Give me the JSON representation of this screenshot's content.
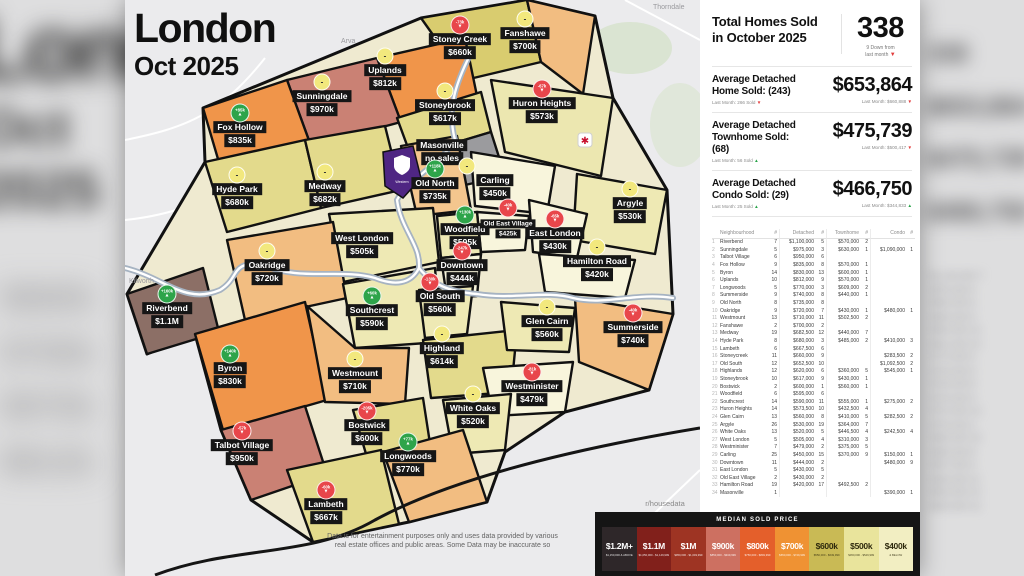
{
  "title": {
    "line1": "London",
    "line2": "Oct 2025"
  },
  "map": {
    "place_labels": [
      "Arva",
      "Thorndale",
      "Kilworth"
    ],
    "university_label": "Western",
    "badge_colors": {
      "up": "#2ea44a",
      "down": "#e8464b",
      "neutral": "#f2e87d"
    },
    "regions": [
      {
        "id": "stoney-creek",
        "name": "Stoney Creek",
        "price": "$660k",
        "fill": "#d9cc6f",
        "x": 335,
        "y": 46,
        "badge": {
          "dir": "down",
          "text": "-73k"
        }
      },
      {
        "id": "fanshawe",
        "name": "Fanshawe",
        "price": "$700k",
        "fill": "#f2bd81",
        "x": 400,
        "y": 40,
        "badge": {
          "dir": "neutral"
        }
      },
      {
        "id": "sunningdale",
        "name": "Sunningdale",
        "price": "$970k",
        "fill": "#ca8174",
        "x": 197,
        "y": 103,
        "badge": {
          "dir": "neutral"
        }
      },
      {
        "id": "uplands",
        "name": "Uplands",
        "price": "$812k",
        "fill": "#f0954a",
        "x": 260,
        "y": 77,
        "badge": {
          "dir": "neutral"
        }
      },
      {
        "id": "fox-hollow",
        "name": "Fox Hollow",
        "price": "$835k",
        "fill": "#f0954a",
        "x": 115,
        "y": 134,
        "badge": {
          "dir": "up",
          "text": "+85k"
        }
      },
      {
        "id": "stoneybrook",
        "name": "Stoneybrook",
        "price": "$617k",
        "fill": "#e3da8c",
        "x": 320,
        "y": 112,
        "badge": {
          "dir": "neutral"
        }
      },
      {
        "id": "huron-heights",
        "name": "Huron Heights",
        "price": "$573k",
        "fill": "#ece7b0",
        "x": 417,
        "y": 110,
        "badge": {
          "dir": "down",
          "text": "-67k"
        }
      },
      {
        "id": "masonville",
        "name": "Masonville",
        "price": "no sales",
        "fill": "#9b9b9e",
        "x": 317,
        "y": 152
      },
      {
        "id": "hyde-park",
        "name": "Hyde Park",
        "price": "$680k",
        "fill": "#e3da8c",
        "x": 112,
        "y": 196,
        "badge": {
          "dir": "neutral"
        }
      },
      {
        "id": "medway",
        "name": "Medway",
        "price": "$682k",
        "fill": "#e3da8c",
        "x": 200,
        "y": 193,
        "badge": {
          "dir": "neutral"
        }
      },
      {
        "id": "old-north",
        "name": "Old North",
        "price": "$735k",
        "fill": "#f4c68e",
        "x": 310,
        "y": 190,
        "badge": {
          "dir": "up",
          "text": "+118k"
        }
      },
      {
        "id": "carling",
        "name": "Carling",
        "price": "$450k",
        "fill": "#f8f5dc",
        "x": 370,
        "y": 187,
        "badge": {
          "dir": "neutral",
          "dx": -28
        }
      },
      {
        "id": "argyle",
        "name": "Argyle",
        "price": "$530k",
        "fill": "#eee9b4",
        "x": 505,
        "y": 210,
        "badge": {
          "dir": "neutral"
        }
      },
      {
        "id": "woodfield",
        "name": "Woodfield",
        "price": "$595k",
        "fill": "#eee9b4",
        "x": 340,
        "y": 236,
        "badge": {
          "dir": "up",
          "text": "+130k"
        }
      },
      {
        "id": "old-east-village",
        "name": "Old East Village",
        "price": "$425k",
        "fill": "#f8f5dc",
        "x": 383,
        "y": 229,
        "small": true,
        "badge": {
          "dir": "down",
          "text": "-40k"
        }
      },
      {
        "id": "east-london",
        "name": "East London",
        "price": "$430k",
        "fill": "#f8f5dc",
        "x": 430,
        "y": 240,
        "badge": {
          "dir": "down",
          "text": "-65k"
        }
      },
      {
        "id": "west-london",
        "name": "West London",
        "price": "$505k",
        "fill": "#eee9b4",
        "x": 237,
        "y": 245
      },
      {
        "id": "downtown",
        "name": "Downtown",
        "price": "$444k",
        "fill": "#f8f5dc",
        "x": 337,
        "y": 272,
        "badge": {
          "dir": "down",
          "text": "-247k"
        }
      },
      {
        "id": "hamilton-road",
        "name": "Hamilton Road",
        "price": "$420k",
        "fill": "#f8f5dc",
        "x": 472,
        "y": 268,
        "badge": {
          "dir": "neutral"
        }
      },
      {
        "id": "oakridge",
        "name": "Oakridge",
        "price": "$720k",
        "fill": "#f2bd81",
        "x": 142,
        "y": 272,
        "badge": {
          "dir": "neutral"
        }
      },
      {
        "id": "riverbend",
        "name": "Riverbend",
        "price": "$1.1M",
        "fill": "#8c6f66",
        "x": 42,
        "y": 315,
        "badge": {
          "dir": "up",
          "text": "+160k"
        }
      },
      {
        "id": "byron",
        "name": "Byron",
        "price": "$830k",
        "fill": "#f0954a",
        "x": 105,
        "y": 375,
        "badge": {
          "dir": "up",
          "text": "+140k"
        }
      },
      {
        "id": "westmount",
        "name": "Westmount",
        "price": "$710k",
        "fill": "#f2bd81",
        "x": 230,
        "y": 380,
        "badge": {
          "dir": "neutral"
        }
      },
      {
        "id": "southcrest",
        "name": "Southcrest",
        "price": "$590k",
        "fill": "#eee9b4",
        "x": 247,
        "y": 317,
        "badge": {
          "dir": "up",
          "text": "+60k"
        }
      },
      {
        "id": "old-south",
        "name": "Old South",
        "price": "$560k",
        "fill": "#eee9b4",
        "x": 315,
        "y": 303,
        "badge": {
          "dir": "down",
          "text": "-130k",
          "dx": -10
        }
      },
      {
        "id": "highland",
        "name": "Highland",
        "price": "$614k",
        "fill": "#e3da8c",
        "x": 317,
        "y": 355,
        "badge": {
          "dir": "neutral"
        }
      },
      {
        "id": "glen-cairn",
        "name": "Glen Cairn",
        "price": "$560k",
        "fill": "#eee9b4",
        "x": 422,
        "y": 328,
        "badge": {
          "dir": "neutral"
        }
      },
      {
        "id": "summerside",
        "name": "Summerside",
        "price": "$740k",
        "fill": "#f2bd81",
        "x": 508,
        "y": 334,
        "badge": {
          "dir": "down",
          "text": "-40k"
        }
      },
      {
        "id": "westminister",
        "name": "Westminister",
        "price": "$479k",
        "fill": "#f8f5dc",
        "x": 407,
        "y": 393,
        "badge": {
          "dir": "down",
          "text": "-81k"
        }
      },
      {
        "id": "white-oaks",
        "name": "White Oaks",
        "price": "$520k",
        "fill": "#eee9b4",
        "x": 348,
        "y": 415,
        "badge": {
          "dir": "neutral"
        }
      },
      {
        "id": "bostwick",
        "name": "Bostwick",
        "price": "$600k",
        "fill": "#e3da8c",
        "x": 242,
        "y": 432,
        "badge": {
          "dir": "down",
          "text": "-205k"
        }
      },
      {
        "id": "talbot-village",
        "name": "Talbot Village",
        "price": "$950k",
        "fill": "#ca8174",
        "x": 117,
        "y": 452,
        "badge": {
          "dir": "down",
          "text": "-57k"
        }
      },
      {
        "id": "longwoods",
        "name": "Longwoods",
        "price": "$770k",
        "fill": "#f2bd81",
        "x": 283,
        "y": 463,
        "badge": {
          "dir": "up",
          "text": "+77k"
        }
      },
      {
        "id": "lambeth",
        "name": "Lambeth",
        "price": "$667k",
        "fill": "#e3da8c",
        "x": 201,
        "y": 511,
        "badge": {
          "dir": "down",
          "text": "-60k"
        }
      }
    ]
  },
  "panel": {
    "header": {
      "title_line1": "Total Homes Sold",
      "title_line2": "in October 2025",
      "total": "338",
      "total_sub1": "9 Down from",
      "total_sub2": "last month",
      "total_dir": "down"
    },
    "stats": [
      {
        "label1": "Average Detached",
        "label2": "Home Sold: (243)",
        "sub": "Last Month: 266 Sold",
        "sub_dir": "down",
        "value": "$653,864",
        "vsub": "Last Month: $660,888",
        "vsub_dir": "down"
      },
      {
        "label1": "Average Detached",
        "label2": "Townhome Sold: (68)",
        "sub": "Last Month: 56 Sold",
        "sub_dir": "up",
        "value": "$475,739",
        "vsub": "Last Month: $500,417",
        "vsub_dir": "down"
      },
      {
        "label1": "Average Detached",
        "label2": "Condo Sold: (29)",
        "sub": "Last Month: 25 Sold",
        "sub_dir": "up",
        "value": "$466,750",
        "vsub": "Last Month: $344,833",
        "vsub_dir": "up"
      }
    ],
    "table": {
      "headers": [
        "",
        "Neighbourhood",
        "#",
        "Detached",
        "#",
        "Townhome",
        "#",
        "Condo",
        "#"
      ],
      "rows": [
        [
          "1",
          "Riverbend",
          "7",
          "$1,100,000",
          "5",
          "$570,000",
          "2",
          "",
          ""
        ],
        [
          "2",
          "Sunningdale",
          "5",
          "$975,000",
          "3",
          "$630,000",
          "1",
          "$1,090,000",
          "1"
        ],
        [
          "3",
          "Talbot Village",
          "6",
          "$950,000",
          "6",
          "",
          "",
          "",
          ""
        ],
        [
          "4",
          "Fox Hollow",
          "9",
          "$835,000",
          "8",
          "$570,000",
          "1",
          "",
          ""
        ],
        [
          "5",
          "Byron",
          "14",
          "$830,000",
          "13",
          "$600,000",
          "1",
          "",
          ""
        ],
        [
          "6",
          "Uplands",
          "10",
          "$812,000",
          "9",
          "$570,000",
          "1",
          "",
          ""
        ],
        [
          "7",
          "Longwoods",
          "5",
          "$770,000",
          "3",
          "$609,000",
          "2",
          "",
          ""
        ],
        [
          "8",
          "Summerside",
          "9",
          "$740,000",
          "8",
          "$440,000",
          "1",
          "",
          ""
        ],
        [
          "9",
          "Old North",
          "8",
          "$735,000",
          "8",
          "",
          "",
          "",
          ""
        ],
        [
          "10",
          "Oakridge",
          "9",
          "$720,000",
          "7",
          "$430,000",
          "1",
          "$480,000",
          "1"
        ],
        [
          "11",
          "Westmount",
          "13",
          "$710,000",
          "11",
          "$502,500",
          "2",
          "",
          ""
        ],
        [
          "12",
          "Fanshawe",
          "2",
          "$700,000",
          "2",
          "",
          "",
          "",
          ""
        ],
        [
          "13",
          "Medway",
          "19",
          "$682,500",
          "12",
          "$440,000",
          "7",
          "",
          ""
        ],
        [
          "14",
          "Hyde Park",
          "8",
          "$680,000",
          "3",
          "$485,000",
          "2",
          "$410,000",
          "3"
        ],
        [
          "15",
          "Lambeth",
          "6",
          "$667,500",
          "6",
          "",
          "",
          "",
          ""
        ],
        [
          "16",
          "Stoneycreek",
          "11",
          "$660,000",
          "9",
          "",
          "",
          "$283,500",
          "2"
        ],
        [
          "17",
          "Old South",
          "12",
          "$652,500",
          "10",
          "",
          "",
          "$1,092,500",
          "2"
        ],
        [
          "18",
          "Highlands",
          "12",
          "$620,000",
          "6",
          "$360,000",
          "5",
          "$545,000",
          "1"
        ],
        [
          "19",
          "Stoneybrook",
          "10",
          "$617,000",
          "9",
          "$430,000",
          "1",
          "",
          ""
        ],
        [
          "20",
          "Bostwick",
          "2",
          "$600,000",
          "1",
          "$560,000",
          "1",
          "",
          ""
        ],
        [
          "21",
          "Woodfield",
          "6",
          "$595,000",
          "6",
          "",
          "",
          "",
          ""
        ],
        [
          "22",
          "Southcrest",
          "14",
          "$590,000",
          "11",
          "$555,000",
          "1",
          "$275,000",
          "2"
        ],
        [
          "23",
          "Huron Heights",
          "14",
          "$573,500",
          "10",
          "$432,500",
          "4",
          "",
          ""
        ],
        [
          "24",
          "Glen Cairn",
          "13",
          "$560,000",
          "8",
          "$410,000",
          "5",
          "$282,500",
          "2"
        ],
        [
          "25",
          "Argyle",
          "26",
          "$530,000",
          "19",
          "$364,000",
          "7",
          "",
          ""
        ],
        [
          "26",
          "White Oaks",
          "13",
          "$520,000",
          "5",
          "$446,500",
          "4",
          "$242,500",
          "4"
        ],
        [
          "27",
          "West London",
          "5",
          "$505,000",
          "4",
          "$310,000",
          "3",
          "",
          ""
        ],
        [
          "28",
          "Westminister",
          "7",
          "$479,000",
          "2",
          "$375,000",
          "5",
          "",
          ""
        ],
        [
          "29",
          "Carling",
          "25",
          "$450,000",
          "15",
          "$370,000",
          "9",
          "$150,000",
          "1"
        ],
        [
          "30",
          "Downtown",
          "11",
          "$444,000",
          "2",
          "",
          "",
          "$480,000",
          "9"
        ],
        [
          "31",
          "East London",
          "5",
          "$430,000",
          "5",
          "",
          "",
          "",
          ""
        ],
        [
          "32",
          "Old East Village",
          "2",
          "$430,000",
          "2",
          "",
          "",
          "",
          ""
        ],
        [
          "33",
          "Hamilton Road",
          "19",
          "$420,000",
          "17",
          "$492,500",
          "2",
          "",
          ""
        ],
        [
          "34",
          "Masonville",
          "1",
          "",
          "",
          "",
          "",
          "$390,000",
          "1"
        ]
      ]
    }
  },
  "legend": {
    "title": "MEDIAN SOLD PRICE",
    "items": [
      {
        "label": "$1.2M+",
        "sub": "$1,150,000 & ABOVE",
        "color": "#2e2729",
        "text": "#ffffff"
      },
      {
        "label": "$1.1M",
        "sub": "$1,050,000 - $1,149,999",
        "color": "#81201b",
        "text": "#ffffff"
      },
      {
        "label": "$1M",
        "sub": "$950,000 - $1,049,999",
        "color": "#9e3423",
        "text": "#ffffff"
      },
      {
        "label": "$900k",
        "sub": "$850,000 - $949,999",
        "color": "#cd7061",
        "text": "#ffffff"
      },
      {
        "label": "$800k",
        "sub": "$750,000 - $849,999",
        "color": "#e45f2b",
        "text": "#ffffff"
      },
      {
        "label": "$700k",
        "sub": "$650,000 - $749,999",
        "color": "#ef9233",
        "text": "#ffffff"
      },
      {
        "label": "$600k",
        "sub": "$550,000 - $649,999",
        "color": "#c9ba55",
        "text": "#2f2a0e"
      },
      {
        "label": "$500k",
        "sub": "$450,000 - $549,999",
        "color": "#e9e49c",
        "text": "#2f2a0e"
      },
      {
        "label": "$400k",
        "sub": "& BELOW",
        "color": "#f2eec2",
        "text": "#2f2a0e"
      }
    ]
  },
  "footer": {
    "disclaimer1": "Data is for entertainment purposes only and uses data provided by various",
    "disclaimer2": "real estate offices and public areas. Some Data may be inaccurate so",
    "credit": "r/housedata"
  }
}
